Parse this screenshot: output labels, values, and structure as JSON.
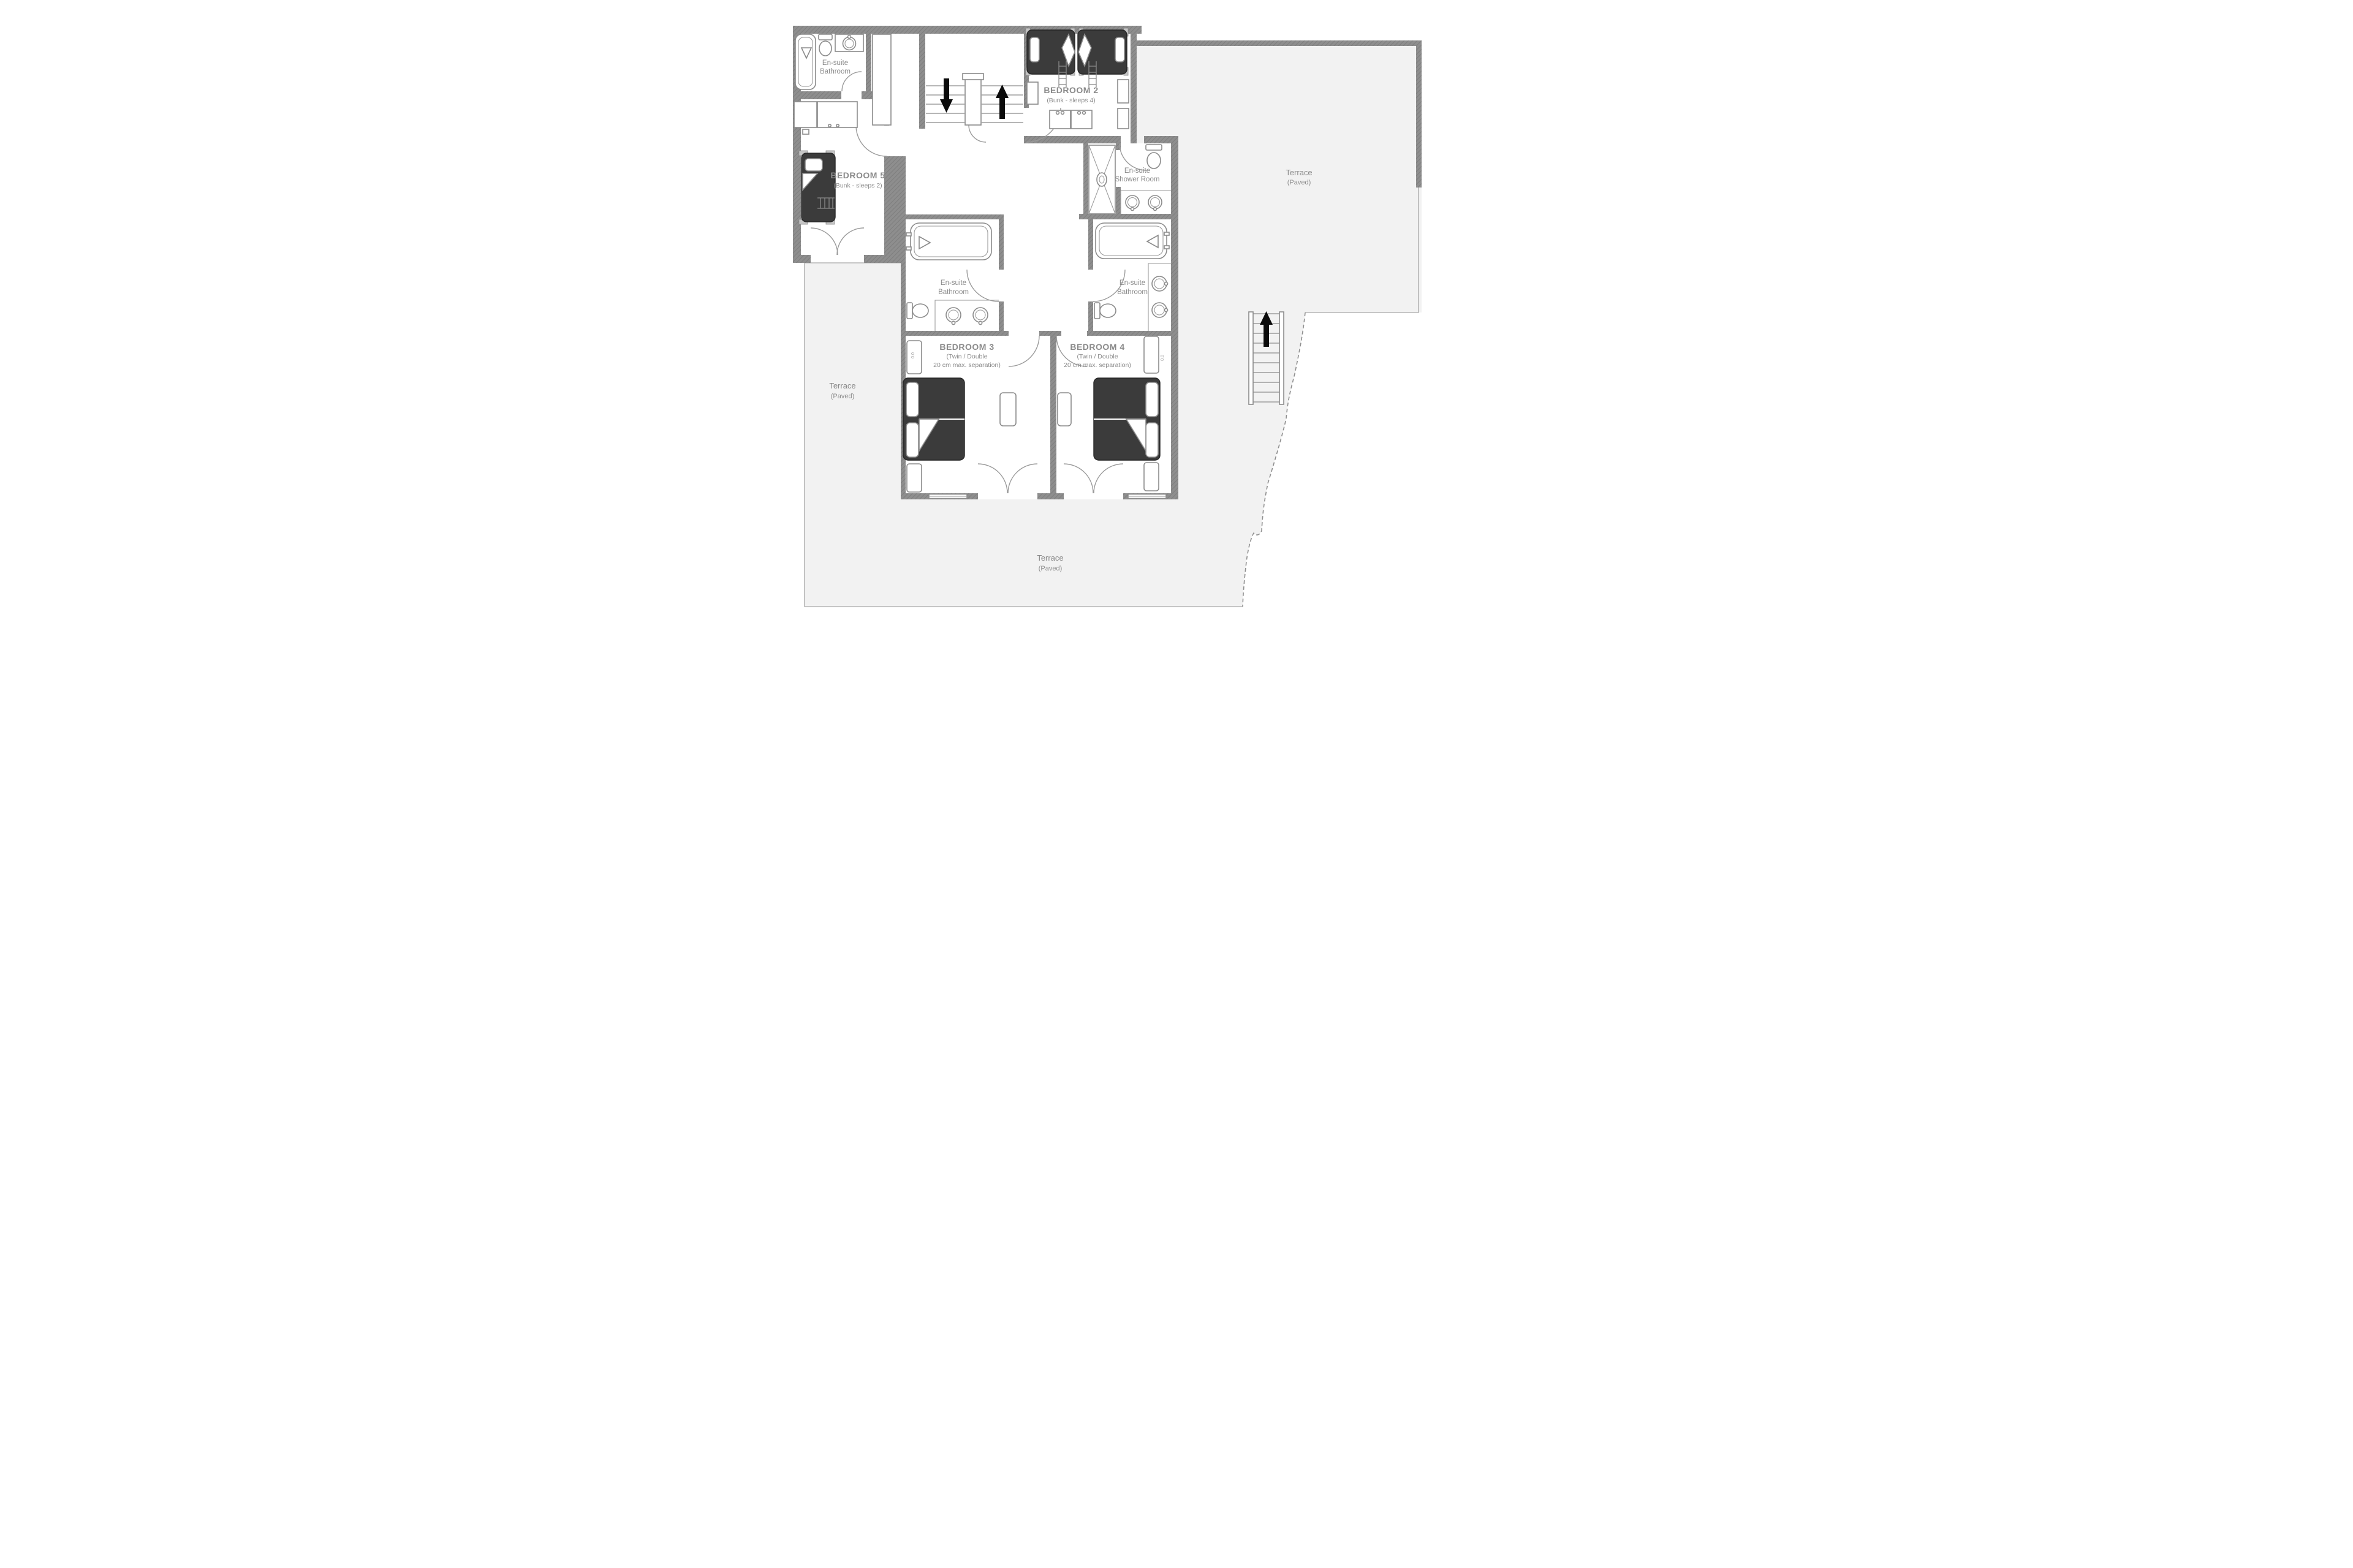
{
  "plan": {
    "type": "floorplan",
    "rooms": {
      "bedroom2": {
        "name": "BEDROOM 2",
        "subtitle": "(Bunk - sleeps 4)"
      },
      "bedroom5": {
        "name": "BEDROOM 5",
        "subtitle": "(Bunk - sleeps 2)"
      },
      "bedroom3": {
        "name": "BEDROOM 3",
        "subtitle_lines": [
          "(Twin / Double",
          "20 cm max. separation)"
        ]
      },
      "bedroom4": {
        "name": "BEDROOM 4",
        "subtitle_lines": [
          "(Twin / Double",
          "20 cm max. separation)"
        ]
      },
      "ensuite_bed5": {
        "line1": "En-suite",
        "line2": "Bathroom"
      },
      "ensuite_shower": {
        "line1": "En-suite",
        "line2": "Shower Room"
      },
      "ensuite_bed3": {
        "line1": "En-suite",
        "line2": "Bathroom"
      },
      "ensuite_bed4": {
        "line1": "En-suite",
        "line2": "Bathroom"
      }
    },
    "terraces": {
      "left": {
        "name": "Terrace",
        "subtitle": "(Paved)"
      },
      "right": {
        "name": "Terrace",
        "subtitle": "(Paved)"
      },
      "bottom": {
        "name": "Terrace",
        "subtitle": "(Paved)"
      }
    },
    "dimension_marks": {
      "bed3": "0.0",
      "bed4": "0.0"
    },
    "colors": {
      "wall": "#8a8a8a",
      "furniture_dark": "#3b3b3b",
      "terrace_fill": "#f2f2f2",
      "label_gray": "#8a8a8a",
      "arrow_black": "#0b0b0b"
    }
  }
}
